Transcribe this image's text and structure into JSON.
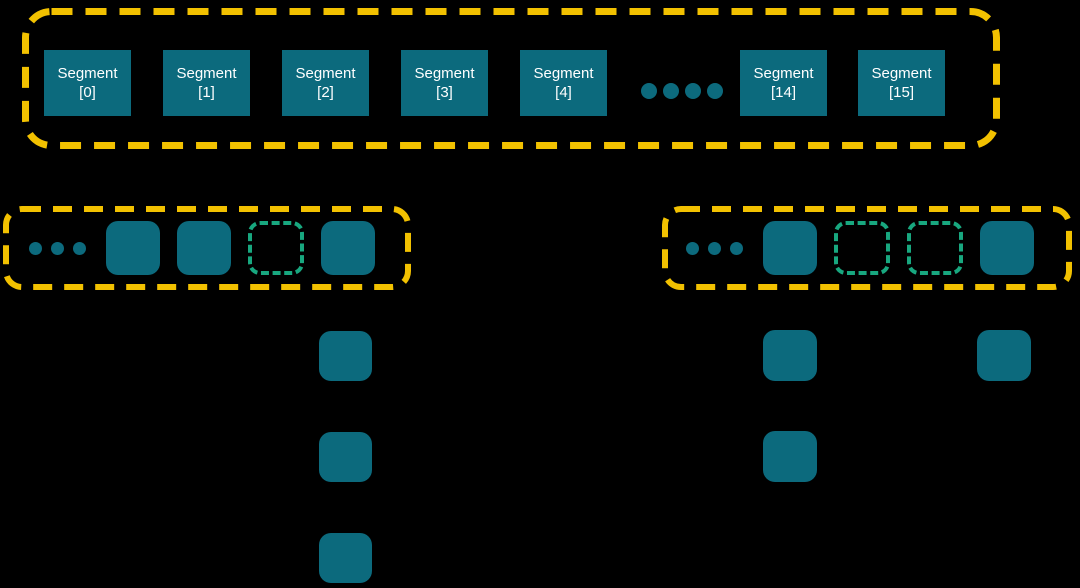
{
  "colors": {
    "bg": "#000000",
    "teal": "#0C6A7D",
    "yellow": "#F2C100",
    "green": "#18A77F",
    "text": "#FFFFFF"
  },
  "top_row": {
    "left_segments": [
      {
        "name": "Segment",
        "index": "[0]"
      },
      {
        "name": "Segment",
        "index": "[1]"
      },
      {
        "name": "Segment",
        "index": "[2]"
      },
      {
        "name": "Segment",
        "index": "[3]"
      },
      {
        "name": "Segment",
        "index": "[4]"
      }
    ],
    "ellipsis_dots": [
      "",
      "",
      "",
      ""
    ],
    "right_segments": [
      {
        "name": "Segment",
        "index": "[14]"
      },
      {
        "name": "Segment",
        "index": "[15]"
      }
    ]
  },
  "buckets": {
    "left": {
      "cells": [
        "ellipsis",
        "filled",
        "filled",
        "empty-dashed",
        "filled"
      ]
    },
    "right": {
      "cells": [
        "ellipsis",
        "filled",
        "empty-dashed",
        "empty-dashed",
        "filled"
      ]
    }
  },
  "chains": {
    "left": {
      "nodes": [
        "",
        "",
        ""
      ]
    },
    "right_a": {
      "nodes": [
        "",
        ""
      ]
    },
    "right_b": {
      "nodes": [
        ""
      ]
    }
  }
}
